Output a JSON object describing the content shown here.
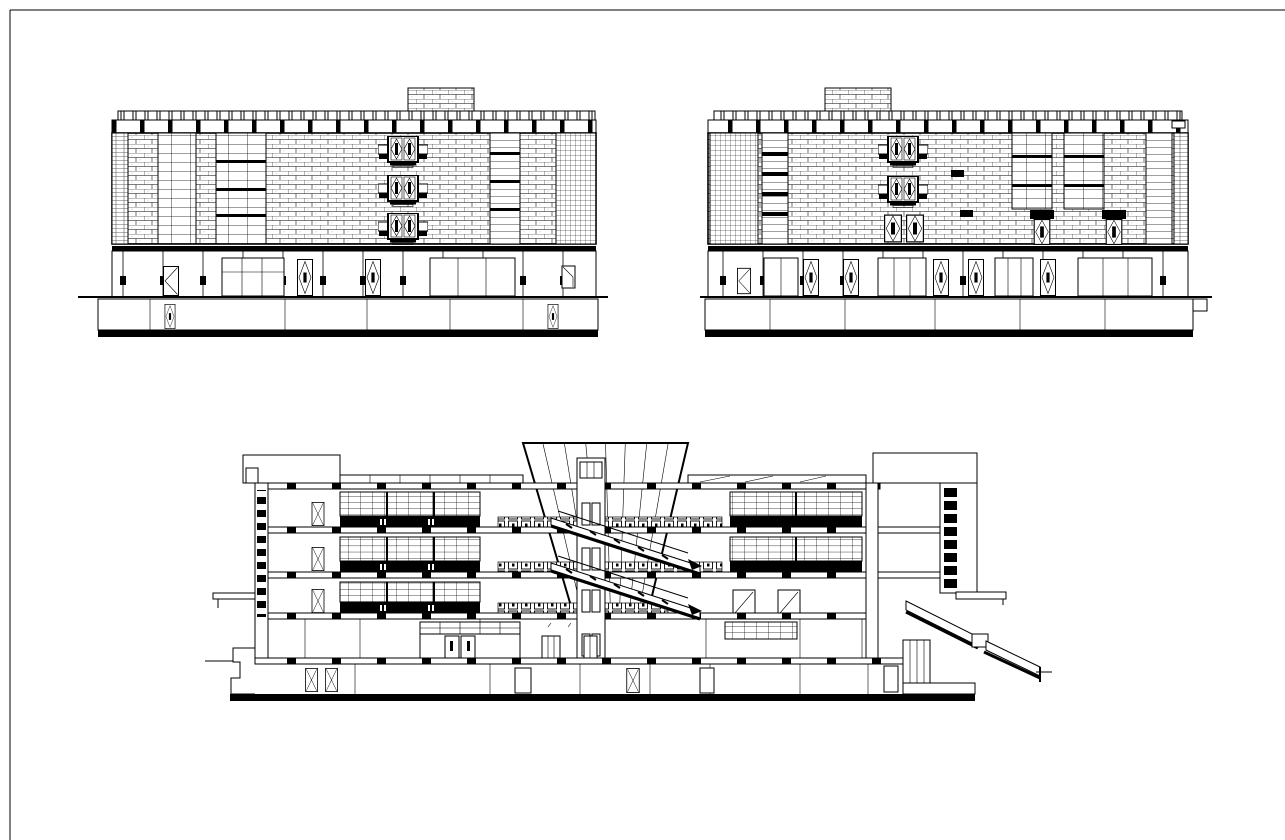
{
  "canvas": {
    "width": 1285,
    "height": 840,
    "background_color": "#ffffff",
    "line_color": "#000000"
  },
  "frame": {
    "label": "drawing sheet border (top and left edges visible)"
  },
  "views": {
    "elevation_left": {
      "label": "building elevation drawing 1 (top left)",
      "stacked_diamond_windows": 3,
      "rooftop_penthouse_position": "right of center",
      "ground_floor_diamond_doors": 2,
      "basement_diamond_doors": 2
    },
    "elevation_right": {
      "label": "building elevation drawing 2 (top right)",
      "stacked_diamond_windows": 2,
      "small_paired_diamond_windows": 2,
      "rooftop_penthouse_position": "left of center",
      "ground_floor_diamond_doors": 5,
      "black_wall_vents": 4
    },
    "section": {
      "label": "building longitudinal section drawing (bottom center)",
      "floors_above_ground": 4,
      "basement_levels": 1,
      "escalator_runs": 2,
      "atrium_skylight": "flared funnel shaped, center",
      "exterior_stair_position": "lower right",
      "glazed_partition_levels_left": 3,
      "glazed_partition_levels_right": 2
    }
  },
  "legend": {
    "hatch_brick": "running-bond brick coursing",
    "hatch_grid": "curtain-wall / window grid",
    "solid_black": "cut structure (slabs, lintels, spandrels)"
  }
}
